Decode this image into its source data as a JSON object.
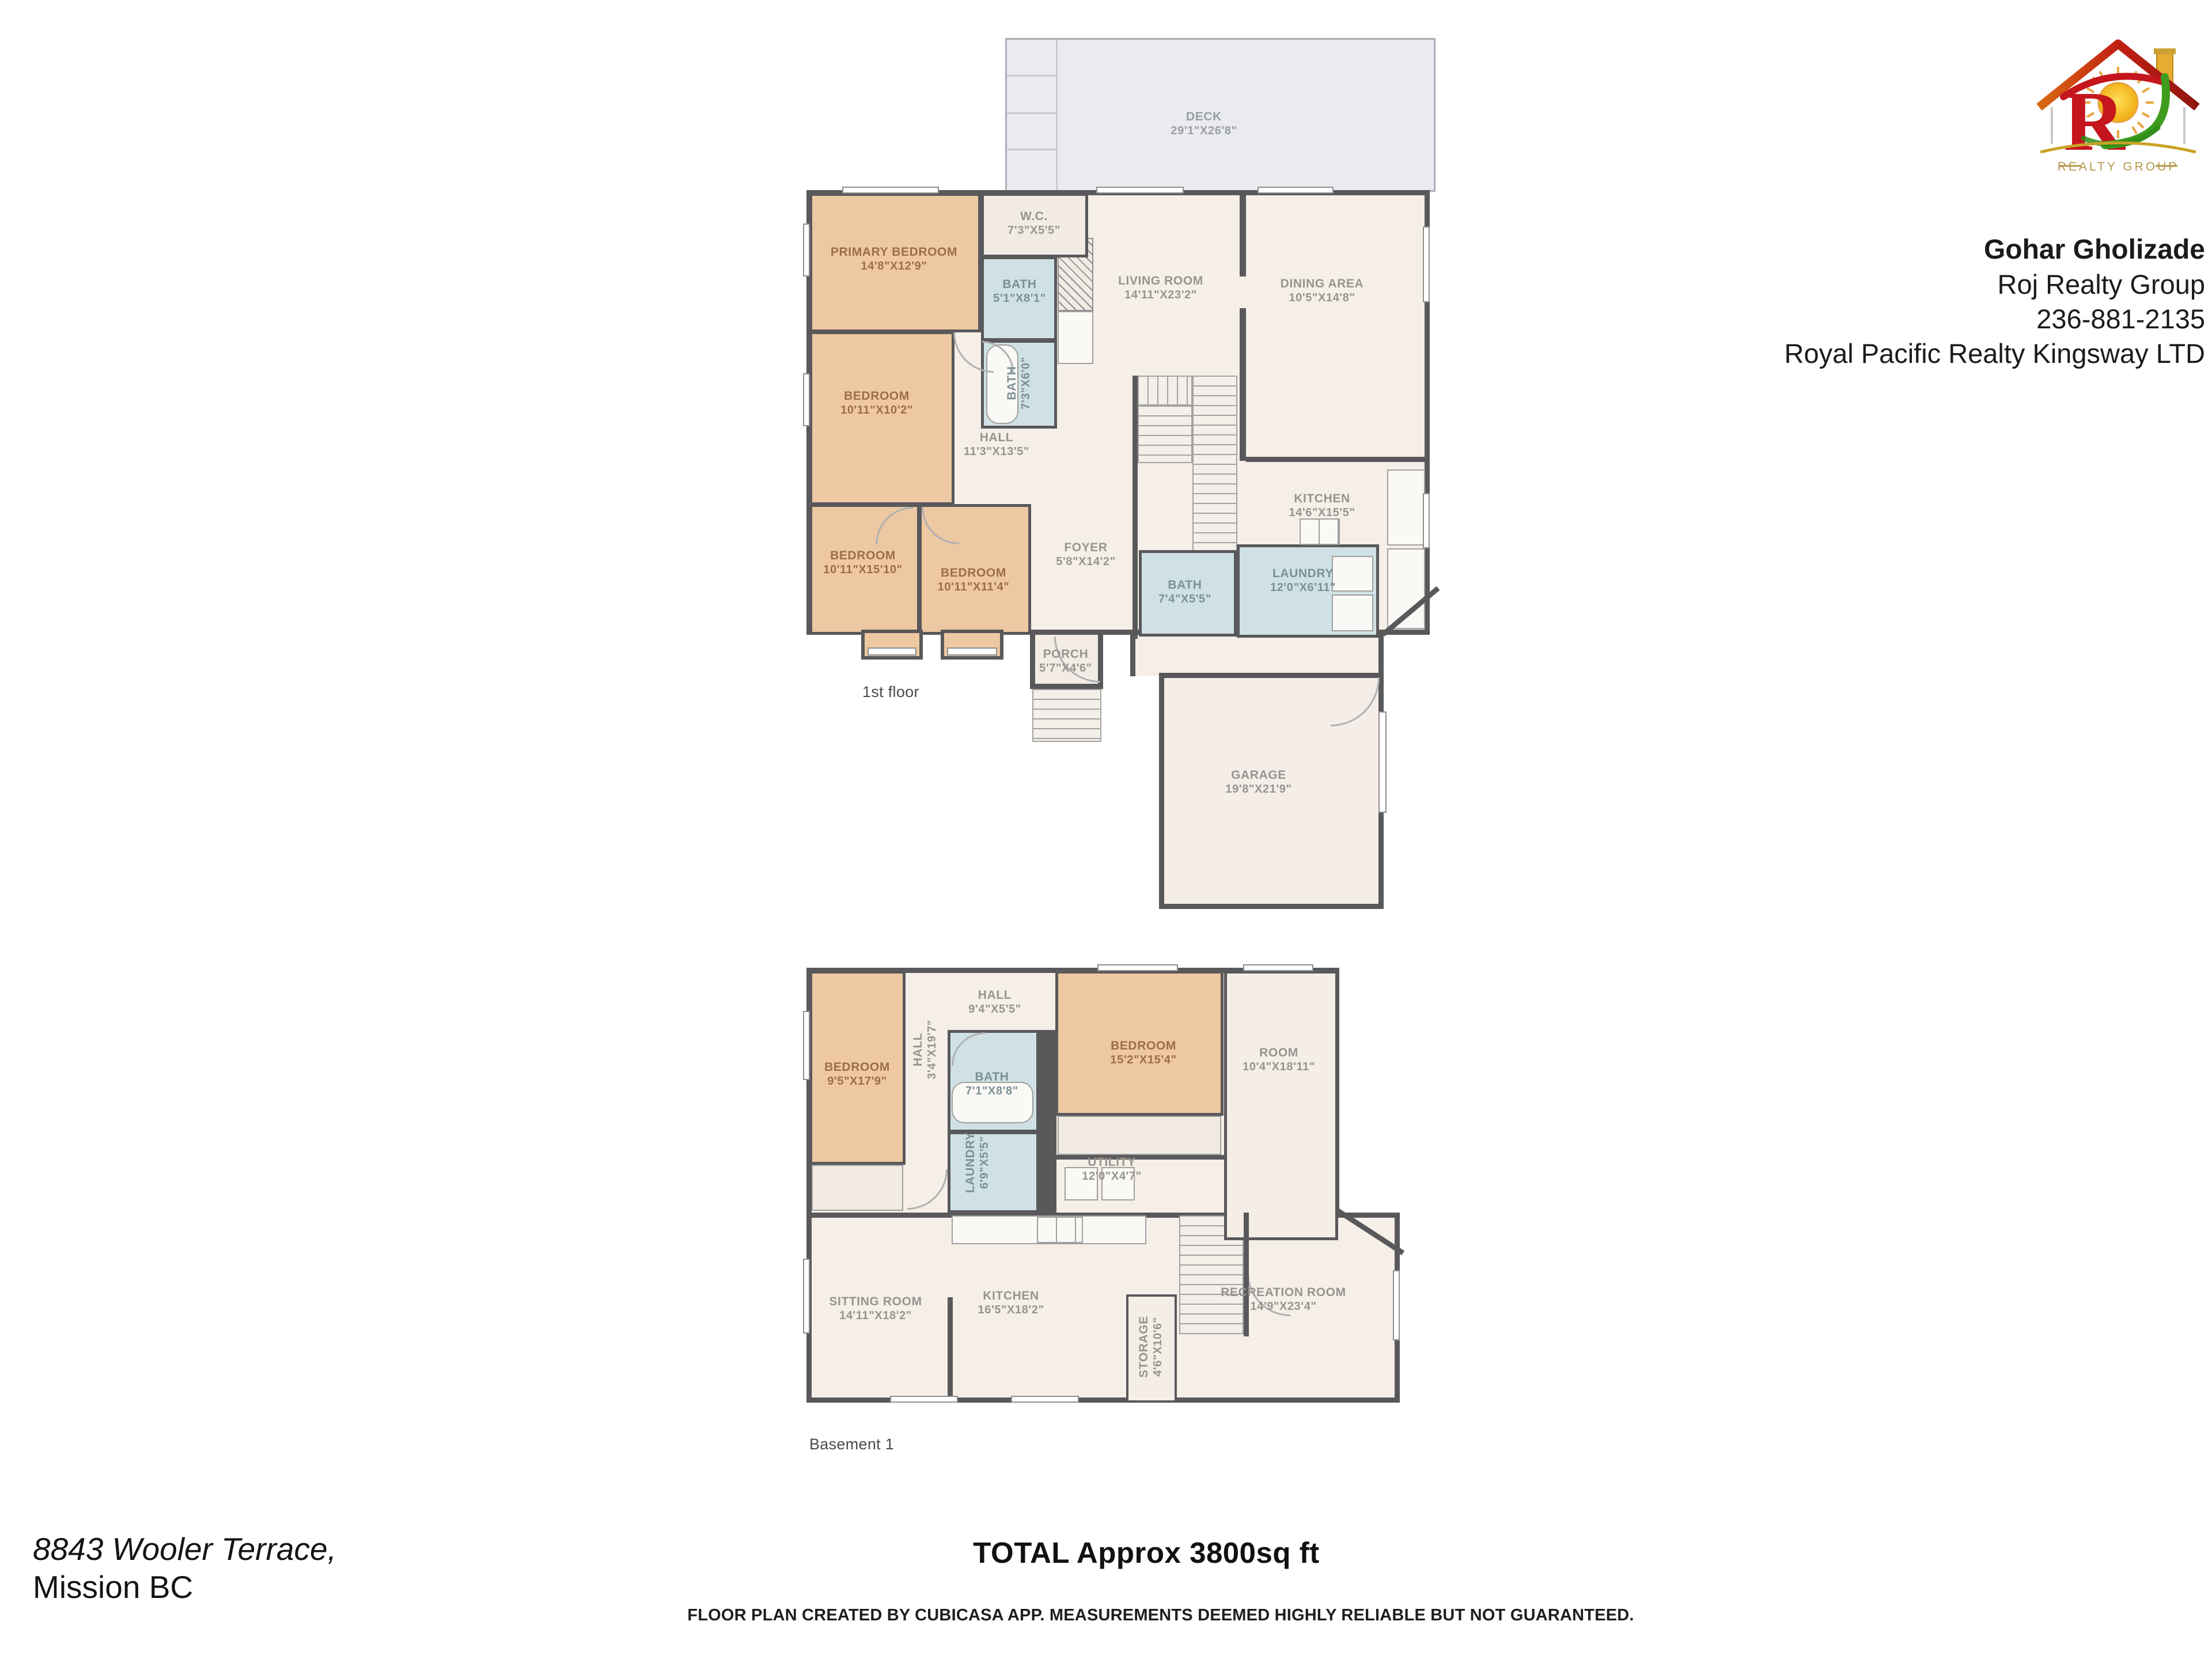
{
  "header": {
    "agent_name": "Gohar Gholizade",
    "agent_company": "Roj Realty Group",
    "agent_phone": "236-881-2135",
    "agent_brokerage": "Royal Pacific Realty Kingsway LTD",
    "logo_realty_group": "REALTY GROUP"
  },
  "floors": {
    "first": {
      "label": "1st floor",
      "rooms": {
        "deck": {
          "name": "DECK",
          "dims": "29'1\"X26'8\""
        },
        "primary": {
          "name": "PRIMARY BEDROOM",
          "dims": "14'8\"X12'9\""
        },
        "wc": {
          "name": "W.C.",
          "dims": "7'3\"X5'5\""
        },
        "bath1": {
          "name": "BATH",
          "dims": "5'1\"X8'1\""
        },
        "bath2": {
          "name": "BATH",
          "dims": "7'3\"X6'0\""
        },
        "bedroom2": {
          "name": "BEDROOM",
          "dims": "10'11\"X10'2\""
        },
        "hall": {
          "name": "HALL",
          "dims": "11'3\"X13'5\""
        },
        "bedroom3": {
          "name": "BEDROOM",
          "dims": "10'11\"X15'10\""
        },
        "bedroom4": {
          "name": "BEDROOM",
          "dims": "10'11\"X11'4\""
        },
        "living": {
          "name": "LIVING ROOM",
          "dims": "14'11\"X23'2\""
        },
        "dining": {
          "name": "DINING AREA",
          "dims": "10'5\"X14'8\""
        },
        "kitchen": {
          "name": "KITCHEN",
          "dims": "14'6\"X15'5\""
        },
        "foyer": {
          "name": "FOYER",
          "dims": "5'8\"X14'2\""
        },
        "bath3": {
          "name": "BATH",
          "dims": "7'4\"X5'5\""
        },
        "laundry": {
          "name": "LAUNDRY",
          "dims": "12'0\"X6'11\""
        },
        "porch": {
          "name": "PORCH",
          "dims": "5'7\"X4'6\""
        },
        "garage": {
          "name": "GARAGE",
          "dims": "19'8\"X21'9\""
        }
      }
    },
    "basement": {
      "label": "Basement 1",
      "rooms": {
        "bedroom1": {
          "name": "BEDROOM",
          "dims": "9'5\"X17'9\""
        },
        "hall_side": {
          "name": "HALL",
          "dims": "3'4\"X19'7\""
        },
        "hall": {
          "name": "HALL",
          "dims": "9'4\"X5'5\""
        },
        "bath": {
          "name": "BATH",
          "dims": "7'1\"X8'8\""
        },
        "laundry": {
          "name": "LAUNDRY",
          "dims": "6'9\"X5'5\""
        },
        "utility": {
          "name": "UTILITY",
          "dims": "12'0\"X4'7\""
        },
        "bedroom2": {
          "name": "BEDROOM",
          "dims": "15'2\"X15'4\""
        },
        "room": {
          "name": "ROOM",
          "dims": "10'4\"X18'11\""
        },
        "sitting": {
          "name": "SITTING ROOM",
          "dims": "14'11\"X18'2\""
        },
        "kitchen": {
          "name": "KITCHEN",
          "dims": "16'5\"X18'2\""
        },
        "storage": {
          "name": "STORAGE",
          "dims": "4'6\"X10'6\""
        },
        "recreation": {
          "name": "RECREATION ROOM",
          "dims": "14'9\"X23'4\""
        }
      }
    }
  },
  "footer": {
    "address_line1": "8843 Wooler Terrace,",
    "address_line2": "Mission BC",
    "total": "TOTAL Approx 3800sq ft",
    "disclaimer": "FLOOR PLAN CREATED BY CUBICASA APP. MEASUREMENTS DEEMED HIGHLY RELIABLE BUT NOT GUARANTEED."
  }
}
